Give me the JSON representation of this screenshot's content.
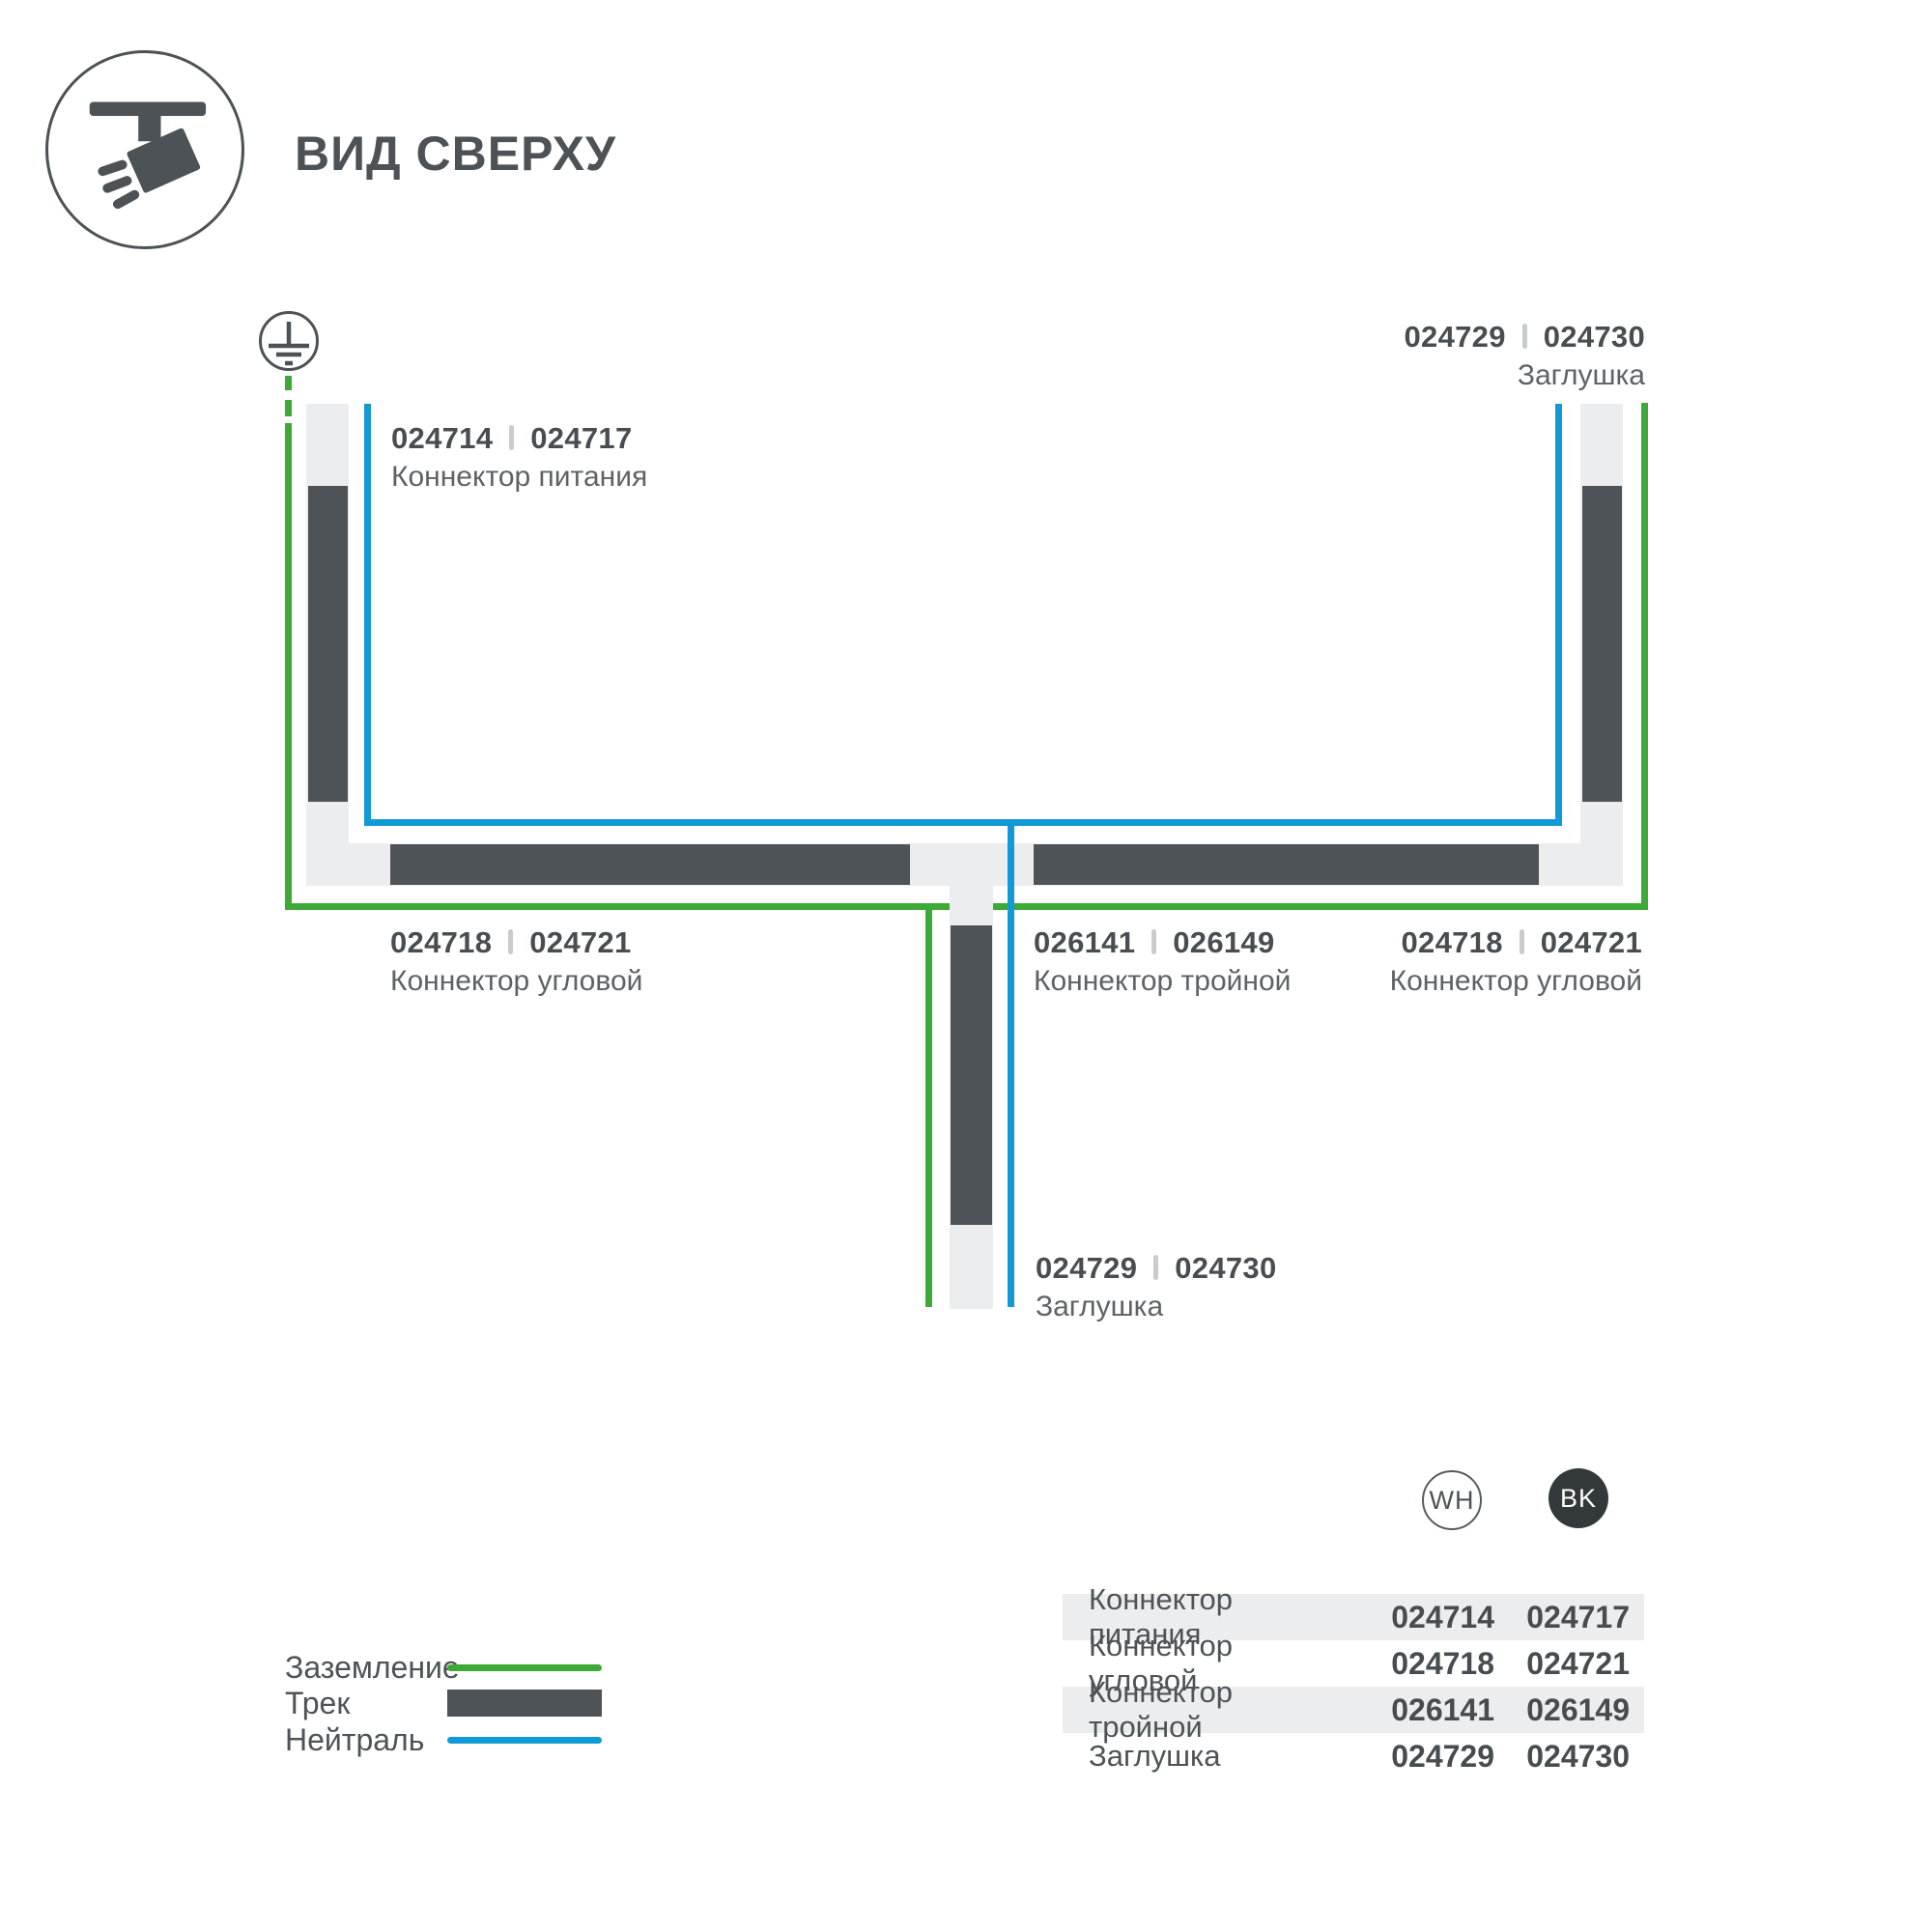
{
  "title": "ВИД СВЕРХУ",
  "colors": {
    "track_dark": "#4e5357",
    "channel_light": "#ecedee",
    "ground_green": "#3da936",
    "neutral_blue": "#129ad7",
    "text_dark": "#4d5356",
    "bk_badge": "#33383b",
    "row_shade": "#ecedee"
  },
  "diagram": {
    "labels": {
      "power": {
        "code_wh": "024714",
        "code_bk": "024717",
        "name": "Коннектор питания"
      },
      "endcap_top": {
        "code_wh": "024729",
        "code_bk": "024730",
        "name": "Заглушка"
      },
      "corner_left": {
        "code_wh": "024718",
        "code_bk": "024721",
        "name": "Коннектор угловой"
      },
      "tee": {
        "code_wh": "026141",
        "code_bk": "026149",
        "name": "Коннектор тройной"
      },
      "corner_right": {
        "code_wh": "024718",
        "code_bk": "024721",
        "name": "Коннектор угловой"
      },
      "endcap_bottom": {
        "code_wh": "024729",
        "code_bk": "024730",
        "name": "Заглушка"
      }
    }
  },
  "legend": {
    "items": [
      {
        "label": "Заземление",
        "type": "green-line"
      },
      {
        "label": "Трек",
        "type": "track-bar"
      },
      {
        "label": "Нейтраль",
        "type": "blue-line"
      }
    ]
  },
  "badges": {
    "wh": "WH",
    "bk": "BK"
  },
  "table": {
    "rows": [
      {
        "name": "Коннектор питания",
        "wh": "024714",
        "bk": "024717"
      },
      {
        "name": "Коннектор угловой",
        "wh": "024718",
        "bk": "024721"
      },
      {
        "name": "Коннектор тройной",
        "wh": "026141",
        "bk": "026149"
      },
      {
        "name": "Заглушка",
        "wh": "024729",
        "bk": "024730"
      }
    ]
  }
}
